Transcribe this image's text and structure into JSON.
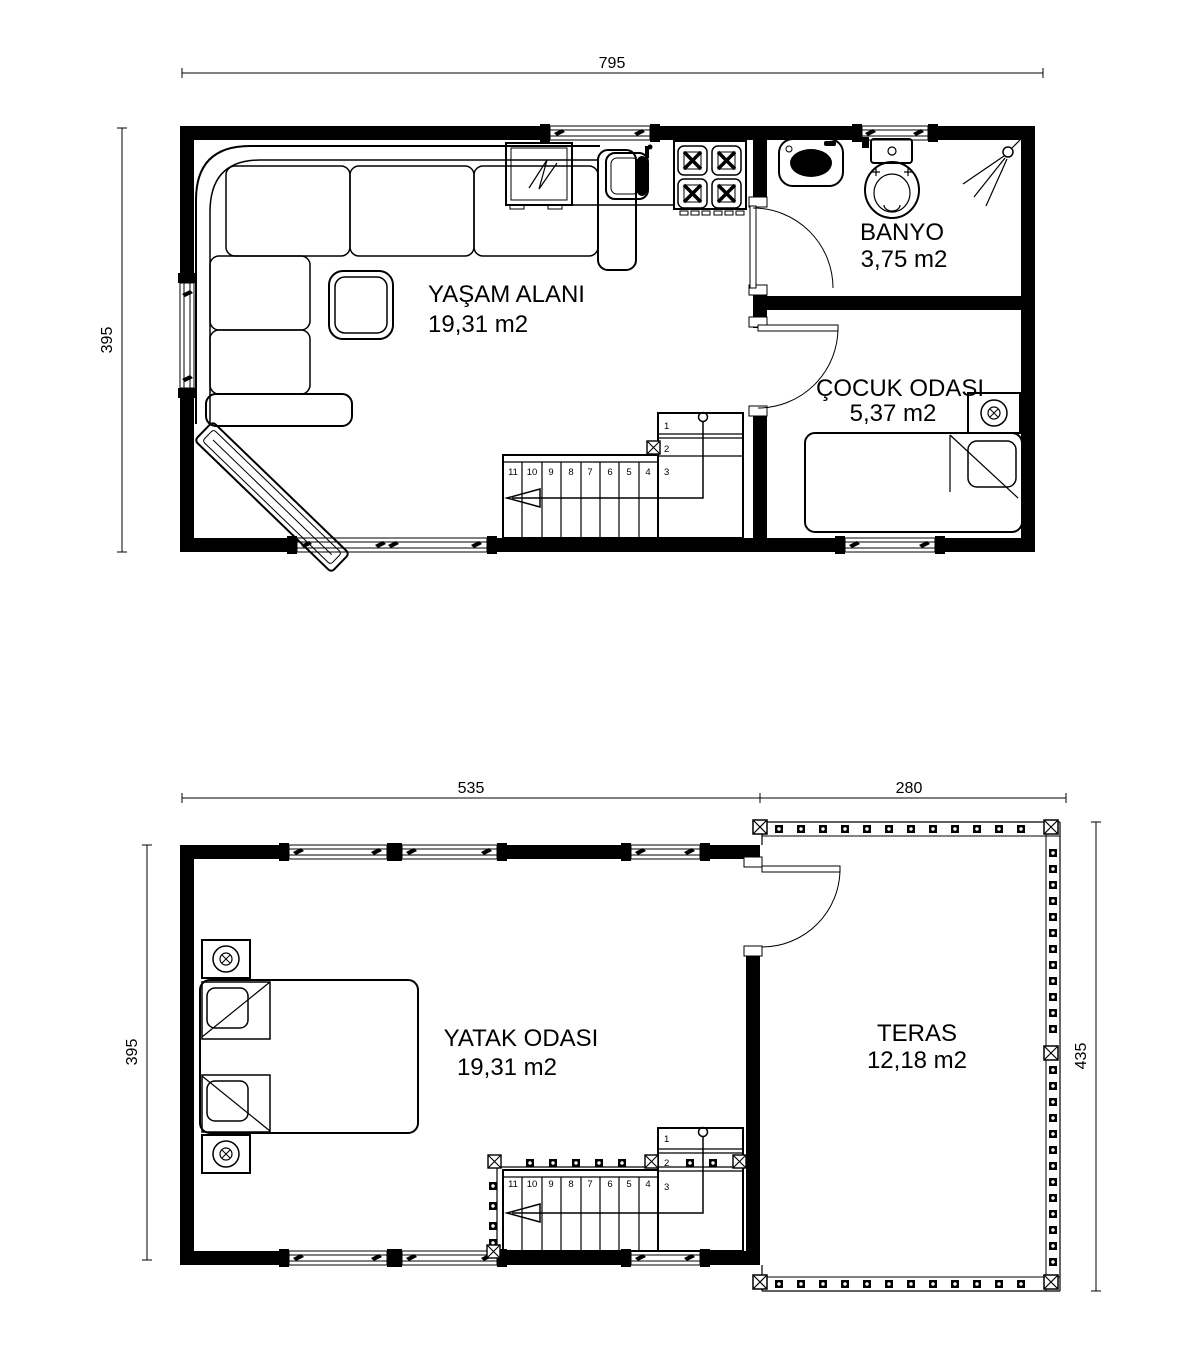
{
  "colors": {
    "line": "#000000",
    "background": "#ffffff"
  },
  "floor_upper": {
    "rooms": [
      {
        "id": "living",
        "name": "YAŞAM ALANI",
        "area": "19,31 m2"
      },
      {
        "id": "bathroom",
        "name": "BANYO",
        "area": "3,75 m2"
      },
      {
        "id": "kids",
        "name": "ÇOCUK ODASI",
        "area": "5,37 m2"
      }
    ],
    "dimensions": {
      "width": "795",
      "height": "395"
    },
    "stair_steps": [
      "1",
      "2",
      "3",
      "4",
      "5",
      "6",
      "7",
      "8",
      "9",
      "10",
      "11"
    ]
  },
  "floor_lower": {
    "rooms": [
      {
        "id": "bedroom",
        "name": "YATAK ODASI",
        "area": "19,31 m2"
      },
      {
        "id": "terrace",
        "name": "TERAS",
        "area": "12,18 m2"
      }
    ],
    "dimensions": {
      "width_left": "535",
      "width_right": "280",
      "height_left": "395",
      "height_right": "435"
    },
    "stair_steps": [
      "1",
      "2",
      "3",
      "4",
      "5",
      "6",
      "7",
      "8",
      "9",
      "10",
      "11"
    ]
  }
}
